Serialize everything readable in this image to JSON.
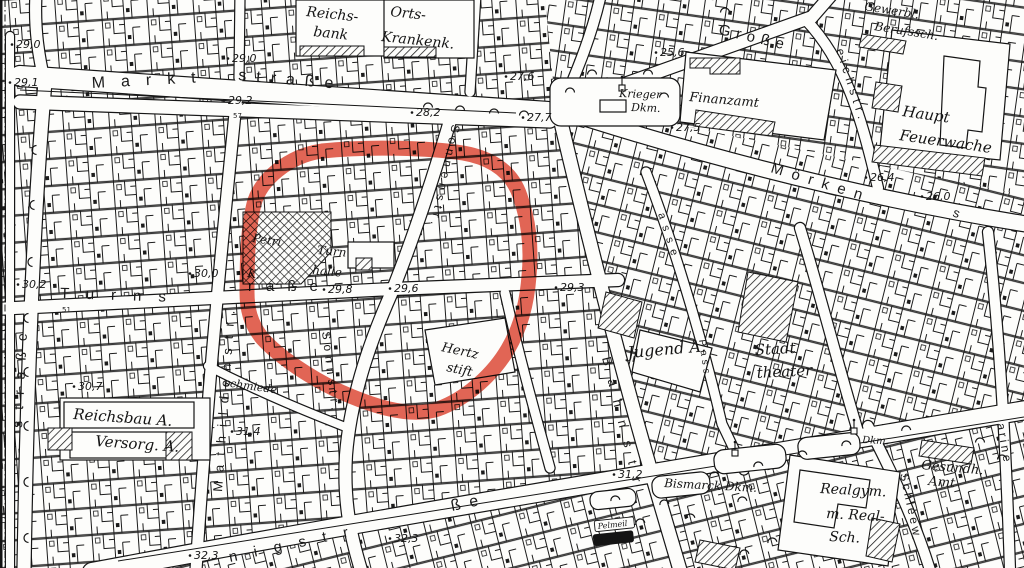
{
  "map": {
    "description": "scanned historic black-and-white city plan with red hand-drawn highlight loop",
    "annotation": {
      "type": "red-highlight-loop",
      "color": "#db3b26"
    },
    "icons": {
      "tree": "arc-tree-symbol",
      "monument": "obelisk-monument-symbol"
    },
    "streets": [
      {
        "id": "marktstrasse-part1",
        "text": "Markt",
        "x": 92,
        "y": 88,
        "rotate": -3,
        "size": 16,
        "spacing": 16
      },
      {
        "id": "marktstrasse-part2",
        "text": "straße",
        "x": 238,
        "y": 80,
        "rotate": 5,
        "size": 16,
        "spacing": 10
      },
      {
        "id": "left-strasse-vertical",
        "text": "straße",
        "x": 22,
        "y": 428,
        "rotate": -87,
        "size": 14,
        "spacing": 11
      },
      {
        "id": "turnstrasse-part1",
        "text": "Turns",
        "x": 60,
        "y": 298,
        "rotate": 2,
        "size": 15,
        "spacing": 17
      },
      {
        "id": "turnstrasse-part2",
        "text": "raße",
        "x": 248,
        "y": 291,
        "rotate": 0,
        "size": 15,
        "spacing": 13
      },
      {
        "id": "sonnenstrasse-upper",
        "text": "Sonnenstr.",
        "x": 452,
        "y": 124,
        "rotate": 102,
        "size": 12,
        "spacing": 5
      },
      {
        "id": "sonnstrasse-lower",
        "text": "Sonnstr.",
        "x": 322,
        "y": 332,
        "rotate": 83,
        "size": 12,
        "spacing": 5
      },
      {
        "id": "mathildenstrasse",
        "text": "Mathildenstr.",
        "x": 222,
        "y": 492,
        "rotate": -86,
        "size": 13,
        "spacing": 9
      },
      {
        "id": "bahnstrasse",
        "text": "Bahnstr",
        "x": 602,
        "y": 358,
        "rotate": 76,
        "size": 13,
        "spacing": 14
      },
      {
        "id": "moerkenstrasse",
        "text": "Mörken",
        "x": 770,
        "y": 172,
        "rotate": 17,
        "size": 15,
        "spacing": 9
      },
      {
        "id": "moerkenstrasse-s",
        "text": "s",
        "x": 952,
        "y": 216,
        "rotate": 20,
        "size": 13,
        "spacing": 0
      },
      {
        "id": "grosse-strasse",
        "text": "Große",
        "x": 718,
        "y": 34,
        "rotate": 13,
        "size": 15,
        "spacing": 6
      },
      {
        "id": "eichstrasse",
        "text": "eichstr.",
        "x": 836,
        "y": 50,
        "rotate": 72,
        "size": 12,
        "spacing": 5
      },
      {
        "id": "schleew-strasse",
        "text": "Schleew",
        "x": 900,
        "y": 474,
        "rotate": 78,
        "size": 12,
        "spacing": 3
      },
      {
        "id": "right-edge-strasse",
        "text": "arine",
        "x": 997,
        "y": 424,
        "rotate": 80,
        "size": 12,
        "spacing": 3
      },
      {
        "id": "koenigstrasse-part1",
        "text": "nigstr",
        "x": 230,
        "y": 562,
        "rotate": -12,
        "size": 15,
        "spacing": 17
      },
      {
        "id": "koenigstrasse-part2",
        "text": "ße",
        "x": 452,
        "y": 511,
        "rotate": -12,
        "size": 16,
        "spacing": 9
      },
      {
        "id": "gasse",
        "text": "asse",
        "x": 658,
        "y": 214,
        "rotate": 72,
        "size": 11,
        "spacing": 7
      },
      {
        "id": "passage",
        "text": "Pass",
        "x": 699,
        "y": 340,
        "rotate": 82,
        "size": 10,
        "spacing": 4
      }
    ],
    "places": [
      {
        "id": "reichsbank",
        "rotate": 6,
        "size": 14,
        "lines": [
          {
            "text": "Reichs-",
            "x": 306,
            "y": 16
          },
          {
            "text": "bank",
            "x": 313,
            "y": 36
          }
        ]
      },
      {
        "id": "orts-krankenkasse",
        "rotate": 6,
        "size": 14,
        "lines": [
          {
            "text": "Orts-",
            "x": 390,
            "y": 16
          },
          {
            "text": "Krankenk.",
            "x": 381,
            "y": 41
          }
        ]
      },
      {
        "id": "krieger-denkmal",
        "rotate": 2,
        "size": 11,
        "lines": [
          {
            "text": "Krieger",
            "x": 619,
            "y": 97
          },
          {
            "text": "Dkm.",
            "x": 631,
            "y": 111
          }
        ]
      },
      {
        "id": "finanzamt",
        "rotate": 5,
        "size": 13,
        "lines": [
          {
            "text": "Finanzamt",
            "x": 689,
            "y": 101
          }
        ]
      },
      {
        "id": "gewerbliche-berufsschule",
        "rotate": 9,
        "size": 12,
        "lines": [
          {
            "text": "Gewerbl.",
            "x": 864,
            "y": 10
          },
          {
            "text": "Berufssch.",
            "x": 874,
            "y": 30
          }
        ]
      },
      {
        "id": "haupt-feuerwache",
        "rotate": 8,
        "size": 15,
        "lines": [
          {
            "text": "Haupt",
            "x": 902,
            "y": 116
          },
          {
            "text": "Feuerwache",
            "x": 899,
            "y": 140
          }
        ]
      },
      {
        "id": "petri-kirche",
        "rotate": 8,
        "size": 12,
        "lines": [
          {
            "text": "Petri",
            "x": 252,
            "y": 242
          },
          {
            "text": "K.",
            "x": 247,
            "y": 277
          }
        ]
      },
      {
        "id": "turnhalle",
        "rotate": 5,
        "size": 12,
        "lines": [
          {
            "text": "Turn",
            "x": 317,
            "y": 254
          },
          {
            "text": "halle",
            "x": 312,
            "y": 274
          }
        ]
      },
      {
        "id": "hertz-stift",
        "rotate": 12,
        "size": 13,
        "lines": [
          {
            "text": "Hertz",
            "x": 441,
            "y": 351
          },
          {
            "text": "stift",
            "x": 446,
            "y": 371
          }
        ]
      },
      {
        "id": "jugend-amt",
        "rotate": -5,
        "size": 16,
        "lines": [
          {
            "text": "Jugend A.",
            "x": 628,
            "y": 358
          }
        ]
      },
      {
        "id": "stadttheater",
        "rotate": -3,
        "size": 15,
        "lines": [
          {
            "text": "Stadt",
            "x": 755,
            "y": 355
          },
          {
            "text": "theater",
            "x": 757,
            "y": 378
          }
        ]
      },
      {
        "id": "schmiede",
        "rotate": 8,
        "size": 11,
        "lines": [
          {
            "text": "schmiede",
            "x": 224,
            "y": 386
          }
        ]
      },
      {
        "id": "reichsbau-versorgungs-amt",
        "rotate": 4,
        "size": 15,
        "lines": [
          {
            "text": "Reichsbau A.",
            "x": 73,
            "y": 419
          },
          {
            "text": "Versorg. A.",
            "x": 95,
            "y": 446
          }
        ]
      },
      {
        "id": "bismarck-denkmal",
        "rotate": 3,
        "size": 12,
        "lines": [
          {
            "text": "Bismarck Dkm.",
            "x": 664,
            "y": 487
          }
        ]
      },
      {
        "id": "denkmal",
        "rotate": 3,
        "size": 10,
        "lines": [
          {
            "text": "Dkm.",
            "x": 862,
            "y": 443
          }
        ]
      },
      {
        "id": "realgymnasium-realschule",
        "rotate": 3,
        "size": 14,
        "lines": [
          {
            "text": "Realgym.",
            "x": 820,
            "y": 493
          },
          {
            "text": "m. Real-",
            "x": 826,
            "y": 518
          },
          {
            "text": "Sch.",
            "x": 829,
            "y": 541
          }
        ]
      },
      {
        "id": "gesundheits-amt",
        "rotate": 5,
        "size": 13,
        "lines": [
          {
            "text": "Gesundh.",
            "x": 921,
            "y": 469
          },
          {
            "text": "Amt",
            "x": 928,
            "y": 485
          }
        ]
      },
      {
        "id": "pelmeil",
        "rotate": -6,
        "size": 8,
        "boxed": "outline",
        "lines": [
          {
            "text": "Pelmeil",
            "x": 598,
            "y": 529
          }
        ]
      },
      {
        "id": "ienialn",
        "rotate": -6,
        "size": 8,
        "boxed": "solid",
        "lines": [
          {
            "text": "ienialn",
            "x": 597,
            "y": 543
          }
        ]
      }
    ],
    "elevations": [
      {
        "text": "29,0",
        "x": 16,
        "y": 48
      },
      {
        "text": "29,1",
        "x": 14,
        "y": 86
      },
      {
        "text": "29,0",
        "x": 232,
        "y": 62
      },
      {
        "text": "29,2",
        "x": 228,
        "y": 104
      },
      {
        "text": "28,2",
        "x": 416,
        "y": 116
      },
      {
        "text": "27,6",
        "x": 510,
        "y": 80
      },
      {
        "text": "27,7",
        "x": 527,
        "y": 121
      },
      {
        "text": "25,6",
        "x": 660,
        "y": 56
      },
      {
        "text": "27,5",
        "x": 676,
        "y": 131
      },
      {
        "text": "26,4",
        "x": 870,
        "y": 181
      },
      {
        "text": "26,0",
        "x": 926,
        "y": 200
      },
      {
        "text": "30,2",
        "x": 22,
        "y": 288
      },
      {
        "text": "30,0",
        "x": 194,
        "y": 277
      },
      {
        "text": "29,8",
        "x": 328,
        "y": 293
      },
      {
        "text": "29,6",
        "x": 394,
        "y": 292
      },
      {
        "text": "29,3",
        "x": 560,
        "y": 291
      },
      {
        "text": "30,7",
        "x": 78,
        "y": 390
      },
      {
        "text": "31,4",
        "x": 236,
        "y": 435
      },
      {
        "text": "31,2",
        "x": 618,
        "y": 478
      },
      {
        "text": "32,3",
        "x": 194,
        "y": 559
      },
      {
        "text": "32,3",
        "x": 394,
        "y": 542
      }
    ],
    "house_numbers": [
      {
        "text": "51",
        "x": 62,
        "y": 312
      },
      {
        "text": "57",
        "x": 233,
        "y": 118
      }
    ]
  }
}
